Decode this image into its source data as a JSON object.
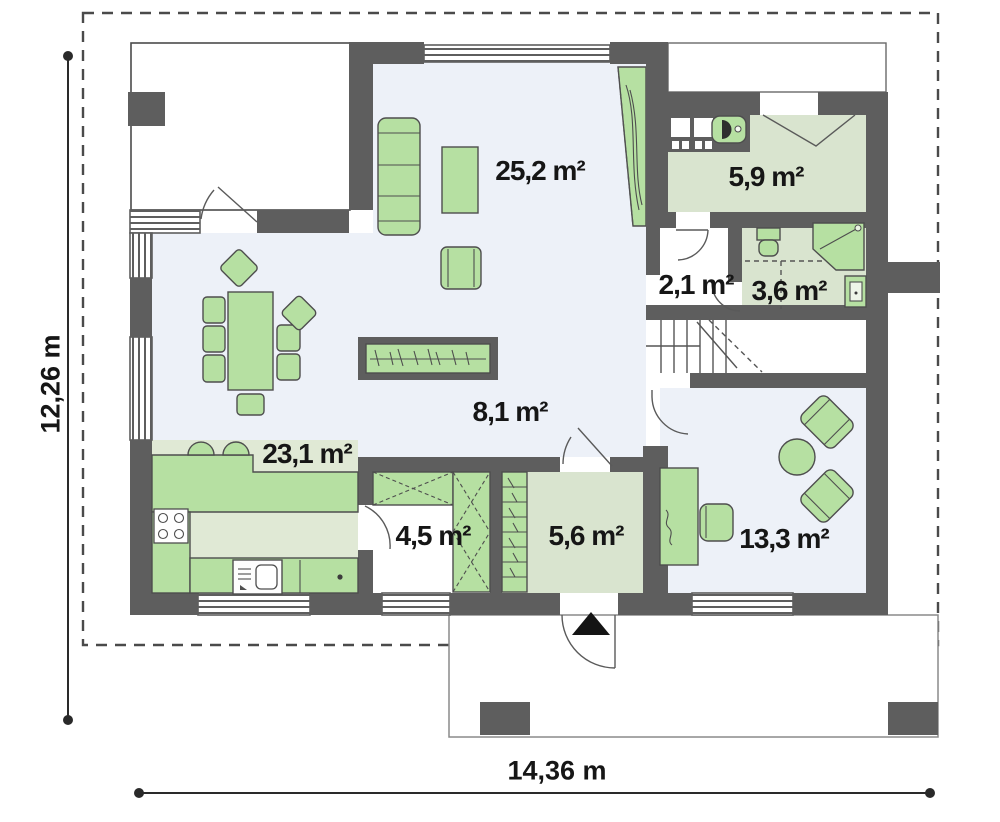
{
  "plan_title": "floor-plan",
  "rooms": [
    {
      "name": "living-room",
      "area": "25,2 m²"
    },
    {
      "name": "utility-room",
      "area": "5,9 m²"
    },
    {
      "name": "corridor",
      "area": "2,1 m²"
    },
    {
      "name": "bathroom",
      "area": "3,6 m²"
    },
    {
      "name": "hall",
      "area": "8,1 m²"
    },
    {
      "name": "kitchen",
      "area": "23,1 m²"
    },
    {
      "name": "wardrobe",
      "area": "4,5 m²"
    },
    {
      "name": "entry",
      "area": "5,6 m²"
    },
    {
      "name": "room",
      "area": "13,3 m²"
    }
  ],
  "dimensions": {
    "height": "12,26 m",
    "width": "14,36 m"
  },
  "colors": {
    "wall": "#5e5e5e",
    "floor": "#edf1f8",
    "room_green": "#d9e4cf",
    "kitchen_green": "#e0e9d5",
    "furniture": "#b6e0a2",
    "furniture_border": "#4e4e4e",
    "dashed_line": "#4a4a4a",
    "dimension": "#2a2a2a"
  }
}
